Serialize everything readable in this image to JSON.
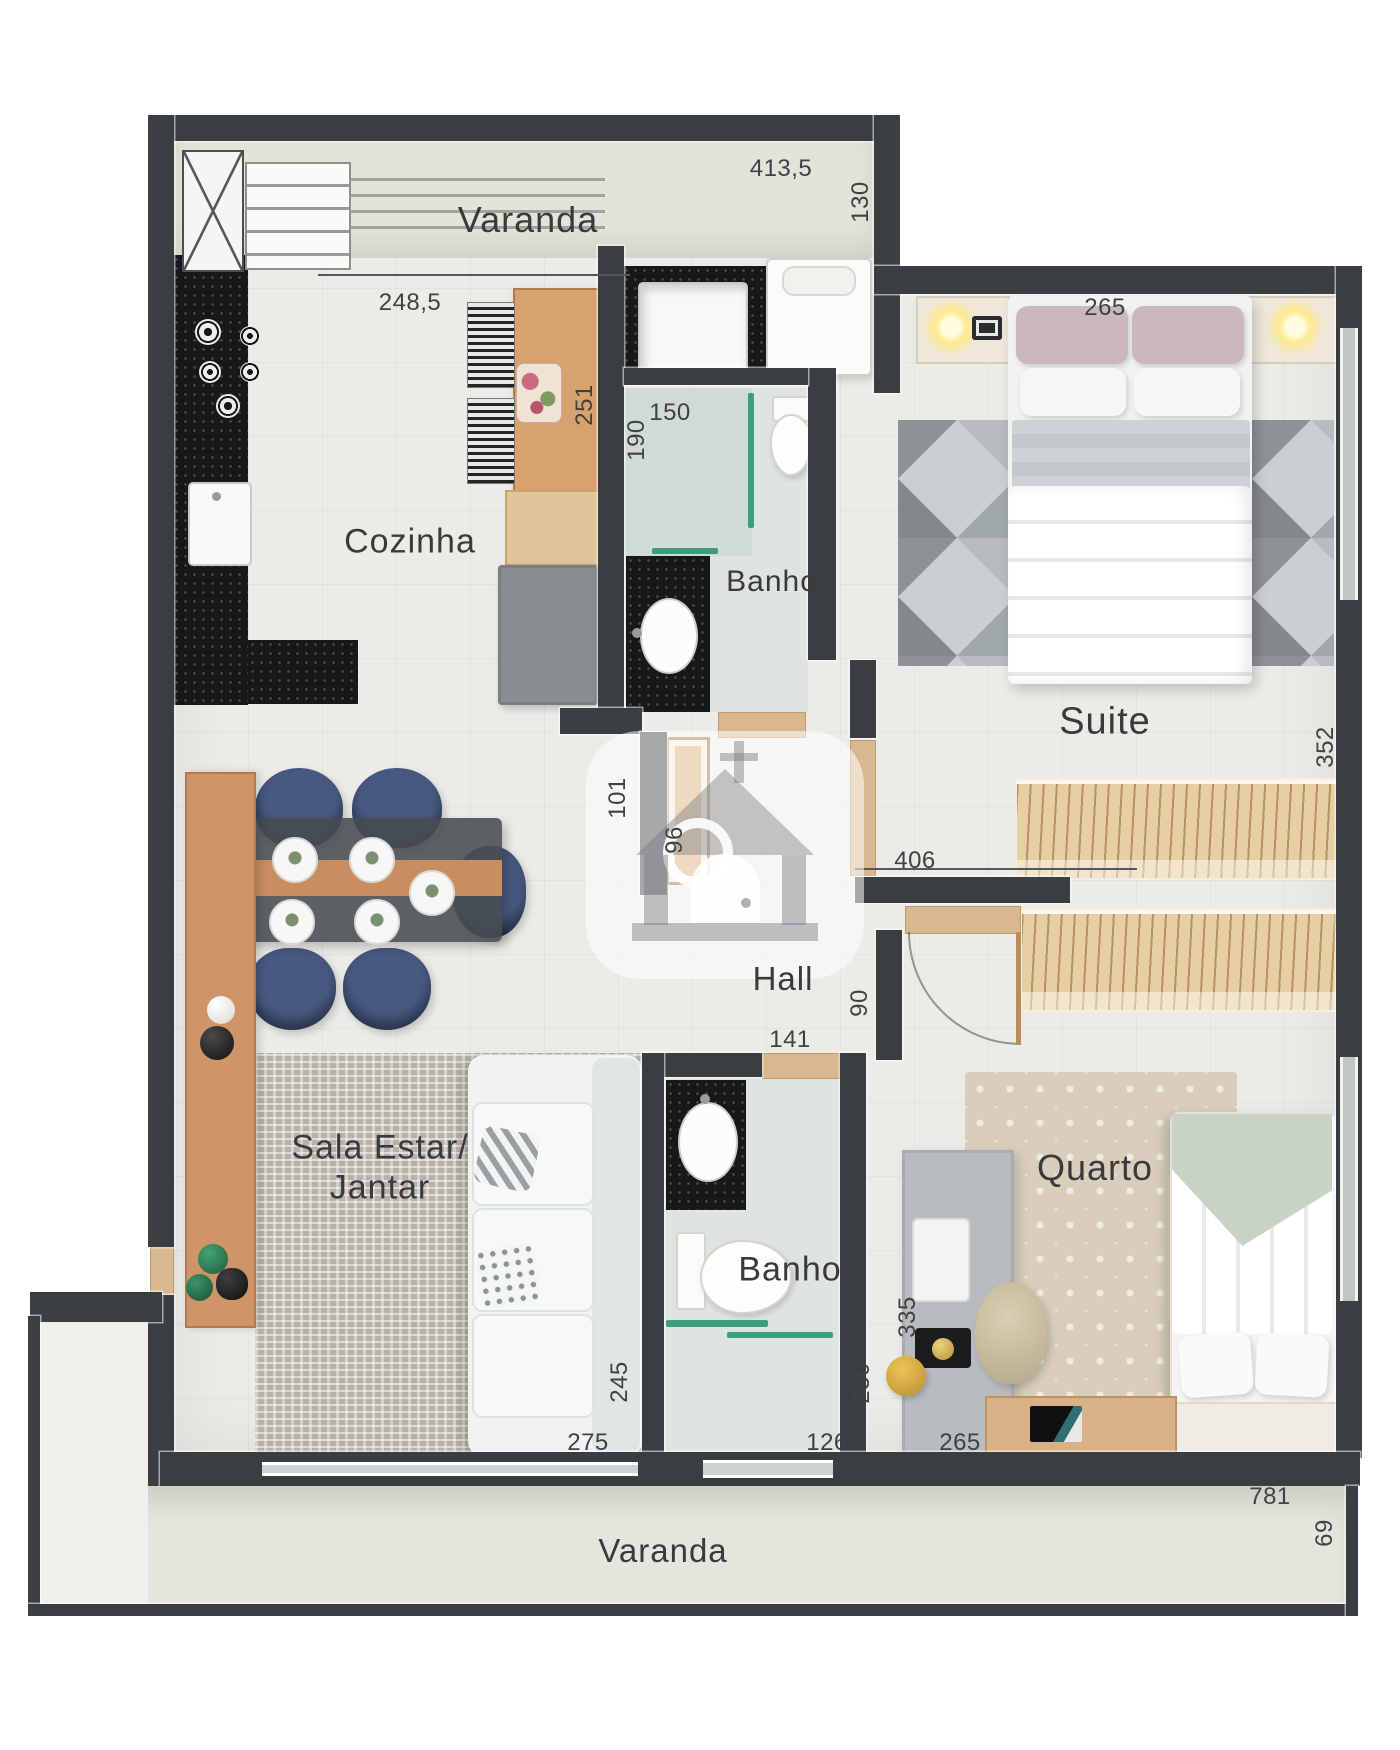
{
  "palette": {
    "wall": "#3a3e41",
    "floor": "#ebebe8",
    "varanda_floor": "#e4e3da",
    "granite": "#17181a",
    "wood": "#cf9468",
    "wood_light": "#e6cfa3",
    "navy_chair": "#3e517e",
    "glass_green": "#21926f",
    "sage": "#c9d3c5",
    "label_text": "#3a3a3a"
  },
  "watermark": {
    "icon": "house-logo-icon"
  },
  "rooms": {
    "varanda_top": "Varanda",
    "cozinha": "Cozinha",
    "banho_top": "Banho",
    "suite": "Suite",
    "hall": "Hall",
    "sala_line1": "Sala Estar/",
    "sala_line2": "Jantar",
    "banho_bottom": "Banho",
    "quarto": "Quarto",
    "varanda_bottom": "Varanda"
  },
  "dims": {
    "d1": "413,5",
    "d2": "130",
    "d3": "248,5",
    "d4": "251",
    "d5": "150",
    "d6": "190",
    "d7": "265",
    "d8": "352",
    "d9": "101",
    "d10": "96",
    "d11": "406",
    "d12": "90",
    "d13": "141",
    "d14": "245",
    "d15": "275",
    "d16": "230",
    "d17": "126",
    "d18": "265",
    "d19": "335",
    "d20": "781",
    "d21": "69"
  }
}
